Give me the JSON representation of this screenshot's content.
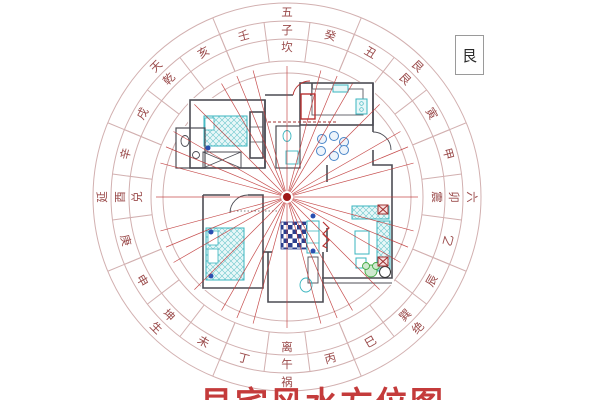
{
  "page": {
    "background": "#ffffff"
  },
  "legend": {
    "label": "艮"
  },
  "caption": {
    "text": "艮宅风水方位图",
    "color": "#c43b3b"
  },
  "compass": {
    "center": {
      "x": 287,
      "y": 197
    },
    "ring_radii": [
      194,
      176,
      158,
      136,
      124
    ],
    "line_color": "#d2b0b0",
    "char_color": "#9a4a4a",
    "star_ring": {
      "radius": 185,
      "items": [
        {
          "char": "五",
          "angle": 0
        },
        {
          "char": "艮",
          "angle": 45
        },
        {
          "char": "六",
          "angle": 90
        },
        {
          "char": "绝",
          "angle": 135
        },
        {
          "char": "祸",
          "angle": 180
        },
        {
          "char": "生",
          "angle": 225
        },
        {
          "char": "延",
          "angle": 270
        },
        {
          "char": "天",
          "angle": 315
        }
      ]
    },
    "mountain_ring": {
      "radius": 167,
      "items": [
        {
          "char": "壬",
          "angle": 345
        },
        {
          "char": "子",
          "angle": 0
        },
        {
          "char": "癸",
          "angle": 15
        },
        {
          "char": "丑",
          "angle": 30
        },
        {
          "char": "艮",
          "angle": 45
        },
        {
          "char": "寅",
          "angle": 60
        },
        {
          "char": "甲",
          "angle": 75
        },
        {
          "char": "卯",
          "angle": 90
        },
        {
          "char": "乙",
          "angle": 105
        },
        {
          "char": "辰",
          "angle": 120
        },
        {
          "char": "巽",
          "angle": 135
        },
        {
          "char": "巳",
          "angle": 150
        },
        {
          "char": "丙",
          "angle": 165
        },
        {
          "char": "午",
          "angle": 180
        },
        {
          "char": "丁",
          "angle": 195
        },
        {
          "char": "未",
          "angle": 210
        },
        {
          "char": "坤",
          "angle": 225
        },
        {
          "char": "申",
          "angle": 240
        },
        {
          "char": "庚",
          "angle": 255
        },
        {
          "char": "酉",
          "angle": 270
        },
        {
          "char": "辛",
          "angle": 285
        },
        {
          "char": "戌",
          "angle": 300
        },
        {
          "char": "乾",
          "angle": 315
        },
        {
          "char": "亥",
          "angle": 330
        }
      ]
    },
    "trigram_ring": {
      "radius": 150,
      "items": [
        {
          "char": "坎",
          "angle": 0
        },
        {
          "char": "震",
          "angle": 90
        },
        {
          "char": "离",
          "angle": 180
        },
        {
          "char": "兑",
          "angle": 270
        }
      ]
    },
    "sector_lines": {
      "start_angle": 7.5,
      "step": 15,
      "count": 24,
      "r_inner": 136,
      "r_outer": 176
    },
    "major_lines": {
      "start_angle": 22.5,
      "step": 45,
      "count": 8,
      "r_inner": 136,
      "r_outer": 194
    },
    "rays": {
      "angles_step": 15,
      "count": 24,
      "extra_start": 22.5,
      "extra_step": 45,
      "extra_count": 8,
      "r_inner": 6,
      "r_outer": 131,
      "color": "#c03a3a"
    },
    "center_dot": {
      "radius": 4,
      "color": "#a01818"
    }
  },
  "floorplan": {
    "wall_color": "#4c4c54",
    "furniture_color": "#3ab5bf",
    "rug_color": "#2b3f8e",
    "accent_red": "#b83232",
    "plant_color": "#44aa44",
    "dot_color": "#2a4fb0",
    "table_circle_color": "#4a86c8"
  }
}
